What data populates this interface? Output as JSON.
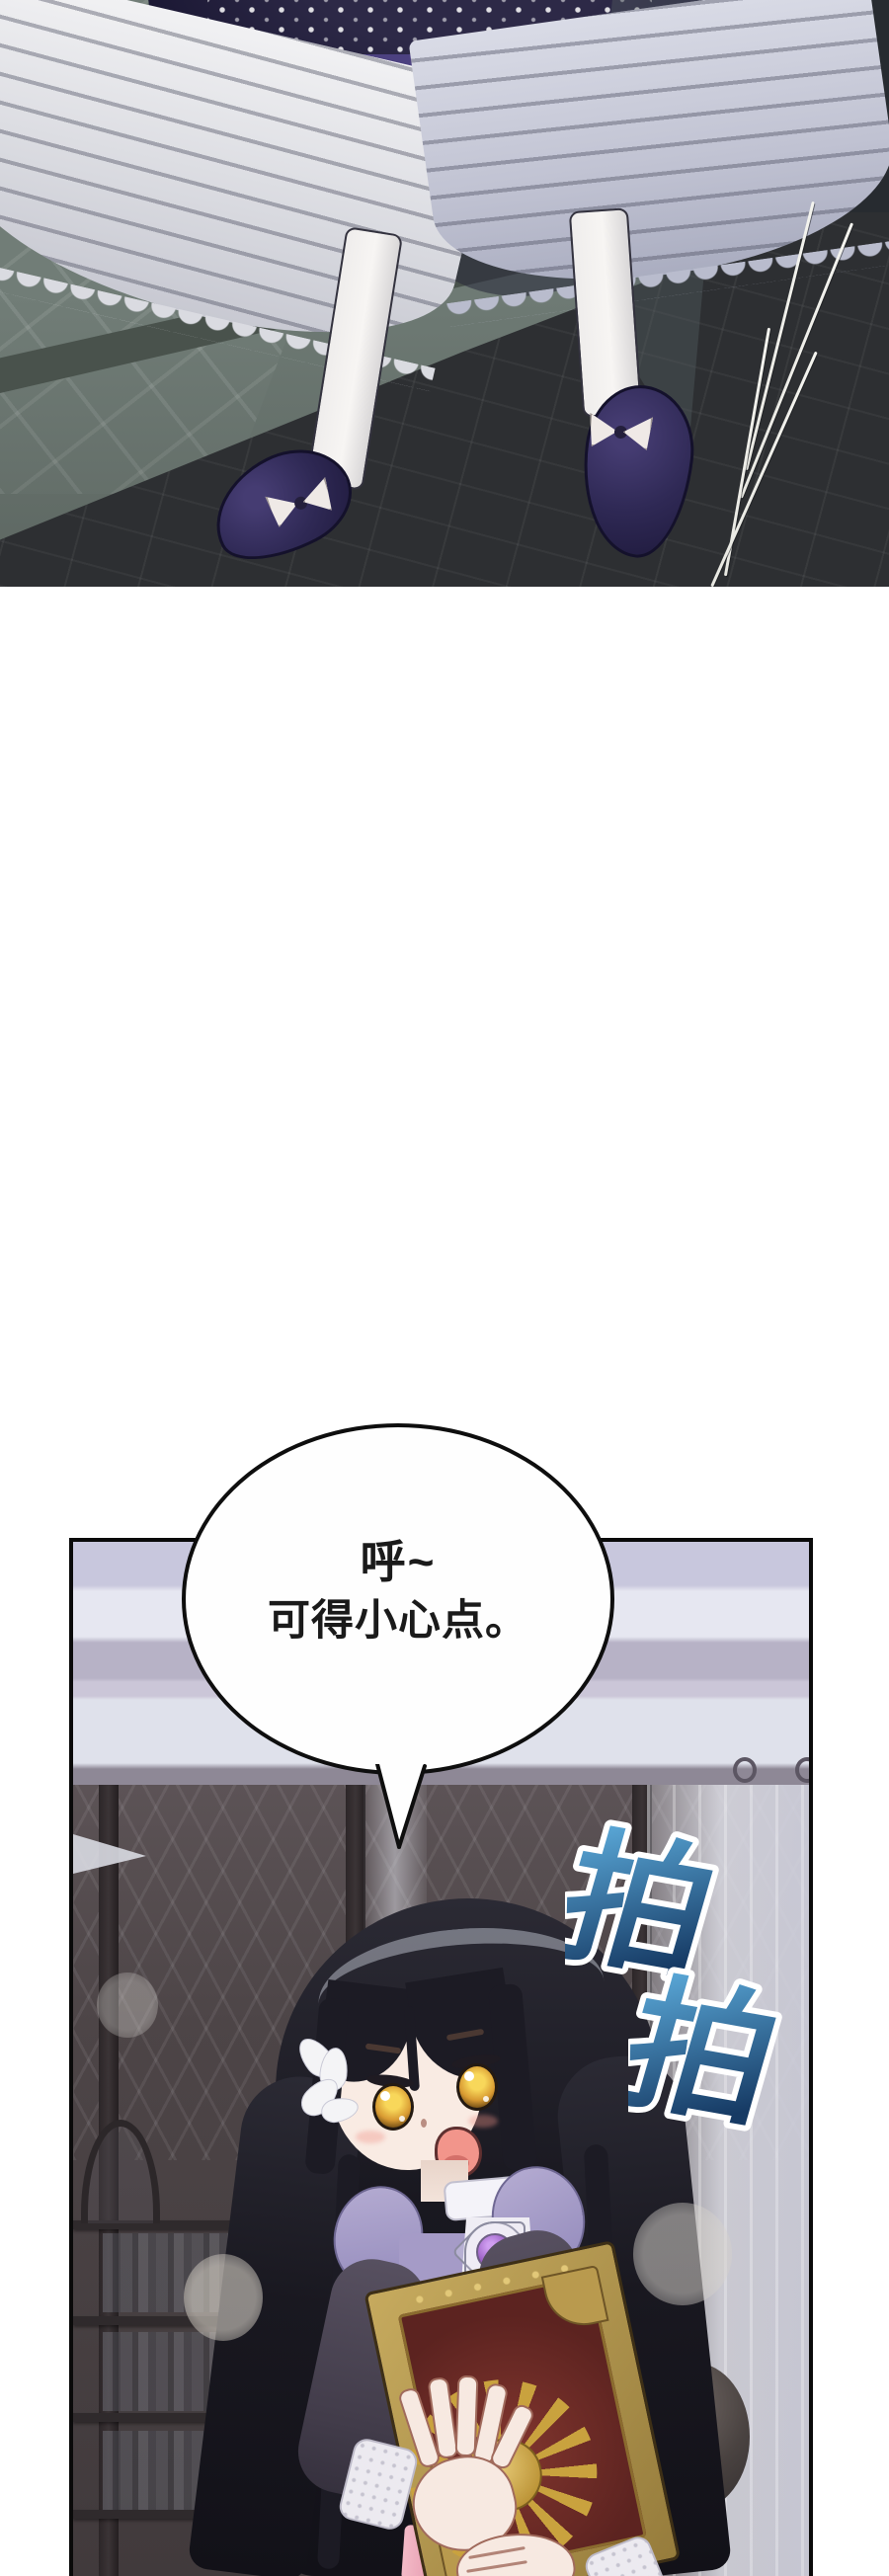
{
  "comic": {
    "speech_bubble": {
      "lines": [
        "呼~",
        "可得小心点。"
      ],
      "fill": "#fefefe",
      "border_color": "#0e0e0e"
    },
    "sfx": {
      "glyphs": [
        "拍",
        "拍"
      ],
      "outline_color": "#ffffff",
      "gradient_top": "#5fb0e0",
      "gradient_bottom": "#163a64"
    },
    "panels": {
      "top": {
        "name": "feet-on-stone-steps",
        "scene": "white-stockinged legs in dark purple bow shoes beneath a ruffled dress, stepping on a stone ledge",
        "background_color": "#6e7a74",
        "floor_color": "#2d2f32",
        "skirt_navy": "#1a1733",
        "skirt_indigo": "#4c4180",
        "shoe_color": "#2f2955",
        "border": "none"
      },
      "bottom": {
        "name": "girl-holding-book",
        "scene": "black-haired girl with amber eyes and white flower clip, surprised, hugging an ornate red book with gold sun emblem, in front of dark bookshelves and a sheer curtain",
        "border_color": "#0a0a0a",
        "wall_stripe_colors": [
          "#c8c7dd",
          "#e6e7f1",
          "#b7b2c6",
          "#dfe1eb"
        ],
        "bookshelf_color": "#4d4547",
        "hair_color": "#191820",
        "eye_color": "#d89a32",
        "dress_color": "#a59bc7",
        "book_cover_color": "#5c2320",
        "book_gold_color": "#b99a4e",
        "brooch_color": "#9b5fc4",
        "ribbon_color": "#e79cb0"
      }
    }
  }
}
